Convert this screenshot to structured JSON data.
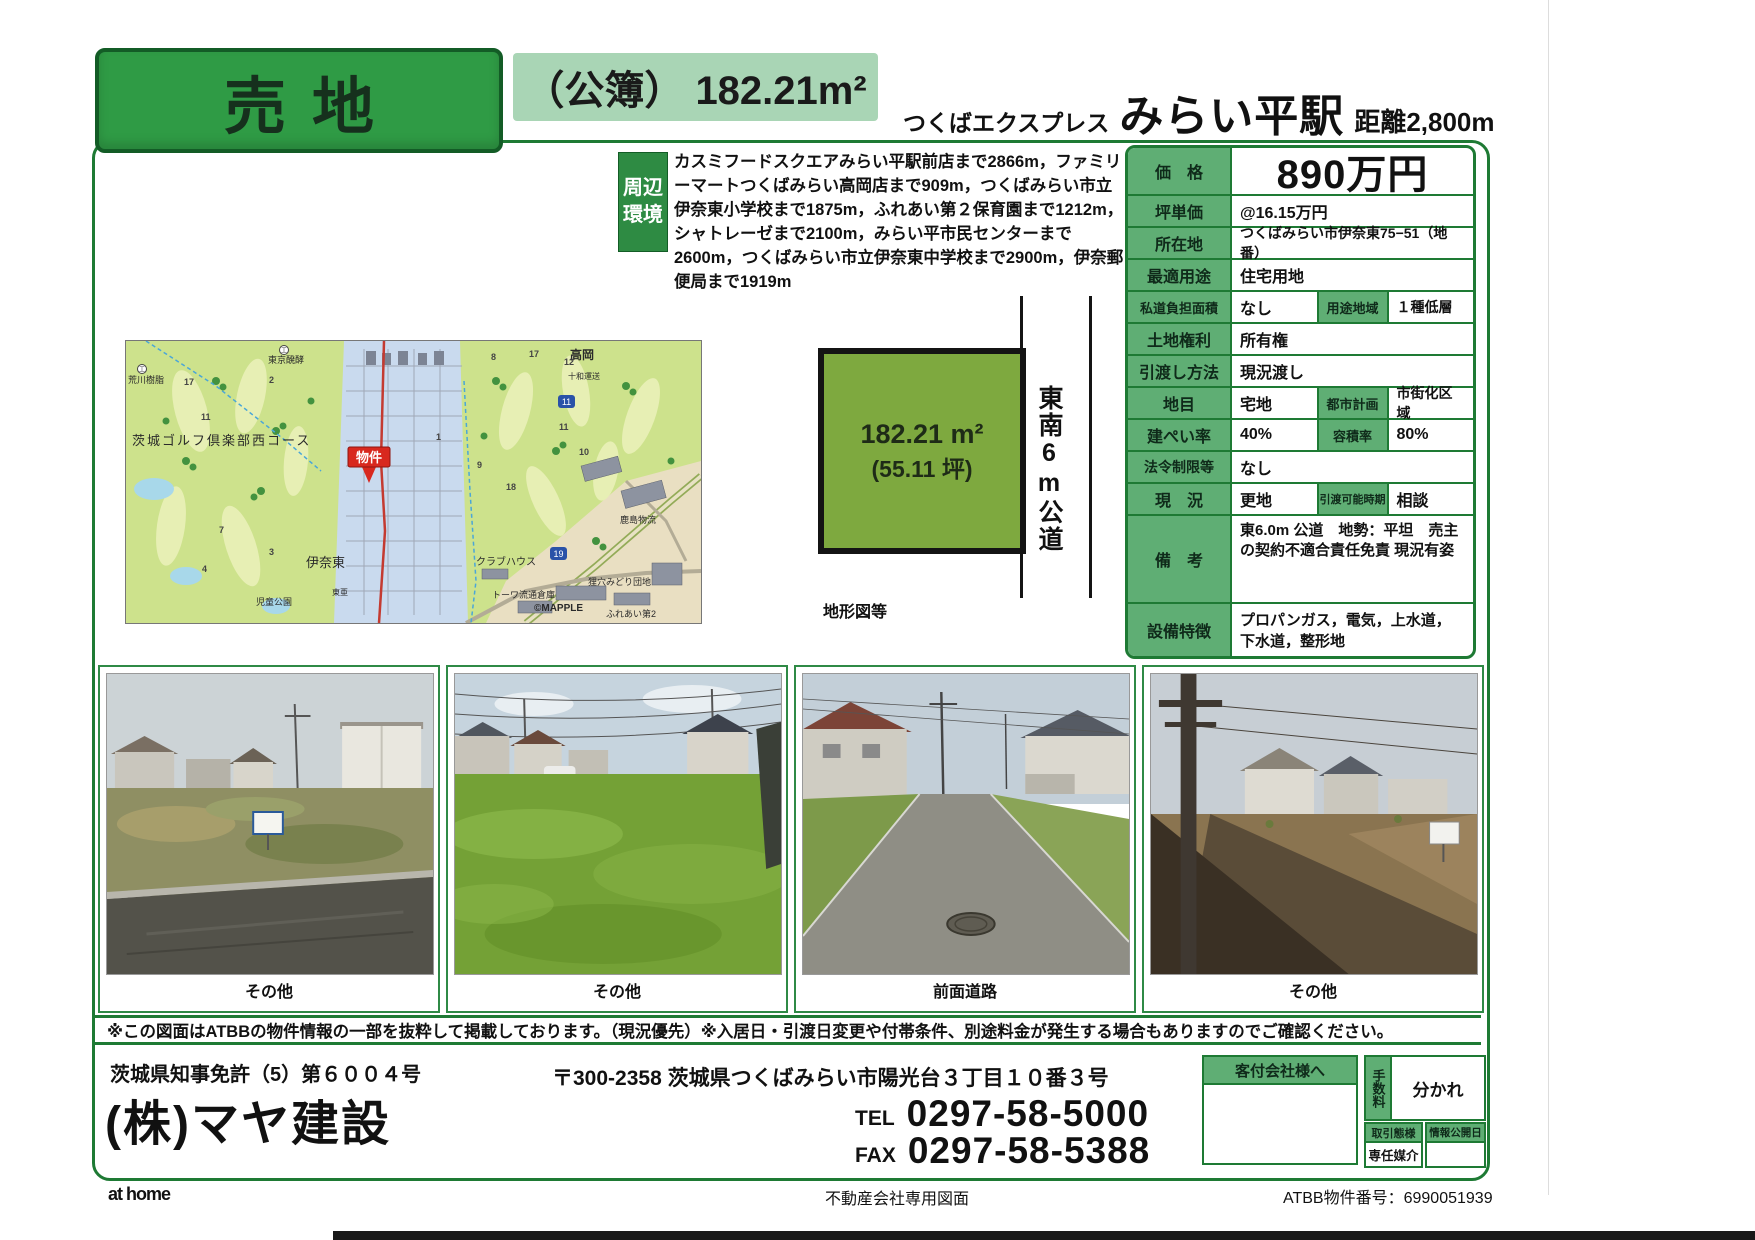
{
  "header": {
    "sale_type": "売地",
    "area_registered": "（公簿） 182.21m²",
    "rail_line": "つくばエクスプレス",
    "station": "みらい平駅",
    "distance": "距離2,800m"
  },
  "surroundings": {
    "label_line1": "周辺",
    "label_line2": "環境",
    "text": "カスミフードスクエアみらい平駅前店まで2866m，ファミリーマートつくばみらい高岡店まで909m，つくばみらい市立伊奈東小学校まで1875m，ふれあい第２保育園まで1212m，シャトレーゼまで2100m，みらい平市民センターまで2600m，つくばみらい市立伊奈東中学校まで2900m，伊奈郵便局まで1919m"
  },
  "map": {
    "marker": "物件",
    "credit": "©MAPPLE",
    "labels": [
      "荒川樹脂",
      "東京醗酵",
      "高岡",
      "十和運送",
      "茨城ゴルフ倶楽部西コース",
      "伊奈東",
      "東亜",
      "クラブハウス",
      "鹿島物流",
      "トーワ流通倉庫",
      "狸穴みどり団地",
      "ふれあい第2",
      "児童公園"
    ],
    "numbers": [
      "17",
      "2",
      "11",
      "7",
      "3",
      "4",
      "1",
      "9",
      "18",
      "8",
      "17",
      "12",
      "11",
      "10"
    ],
    "shields": [
      "11",
      "19"
    ]
  },
  "plot": {
    "area": "182.21 m²",
    "tsubo": "(55.11 坪)",
    "road_label": "東南6m公道",
    "caption": "地形図等"
  },
  "details": {
    "price_label": "価　格",
    "price": "890万円",
    "unit_label": "坪単価",
    "unit": "@16.15万円",
    "location_label": "所在地",
    "location": "つくばみらい市伊奈東75−51（地番）",
    "use_label": "最適用途",
    "use": "住宅用地",
    "private_road_label": "私道負担面積",
    "private_road": "なし",
    "zoning_label": "用途地域",
    "zoning": "１種低層",
    "rights_label": "土地権利",
    "rights": "所有権",
    "handover_label": "引渡し方法",
    "handover": "現況渡し",
    "land_cat_label": "地目",
    "land_cat": "宅地",
    "city_plan_label": "都市計画",
    "city_plan": "市街化区域",
    "bcr_label": "建ぺい率",
    "bcr": "40%",
    "far_label": "容積率",
    "far": "80%",
    "law_label": "法令制限等",
    "law": "なし",
    "status_label": "現　況",
    "status": "更地",
    "delivery_label": "引渡可能時期",
    "delivery": "相談",
    "notes_label": "備　考",
    "notes": "東6.0m 公道　地勢：平坦　売主の契約不適合責任免責 現況有姿",
    "features_label": "設備特徴",
    "features": "プロパンガス，電気，上水道，下水道，整形地"
  },
  "photos": [
    "その他",
    "その他",
    "前面道路",
    "その他"
  ],
  "disclaimer": "※この図面はATBBの物件情報の一部を抜粋して掲載しております。（現況優先）※入居日・引渡日変更や付帯条件、別途料金が発生する場合もありますのでご確認ください。",
  "footer": {
    "license": "茨城県知事免許（5）第６００４号",
    "company": "(株)マヤ建設",
    "address": "〒300-2358 茨城県つくばみらい市陽光台３丁目１０番３号",
    "tel_label": "TEL",
    "tel": "0297-58-5000",
    "fax_label": "FAX",
    "fax": "0297-58-5388",
    "agent_box_label": "客付会社様へ",
    "fee_label": "手数料",
    "fee_value": "分かれ",
    "transaction_label": "取引態様",
    "transaction_value": "専任媒介",
    "publish_label": "情報公開日",
    "publish_value": ""
  },
  "bottom": {
    "logo": "at home",
    "center": "不動産会社専用図面",
    "right": "ATBB物件番号：6990051939"
  }
}
